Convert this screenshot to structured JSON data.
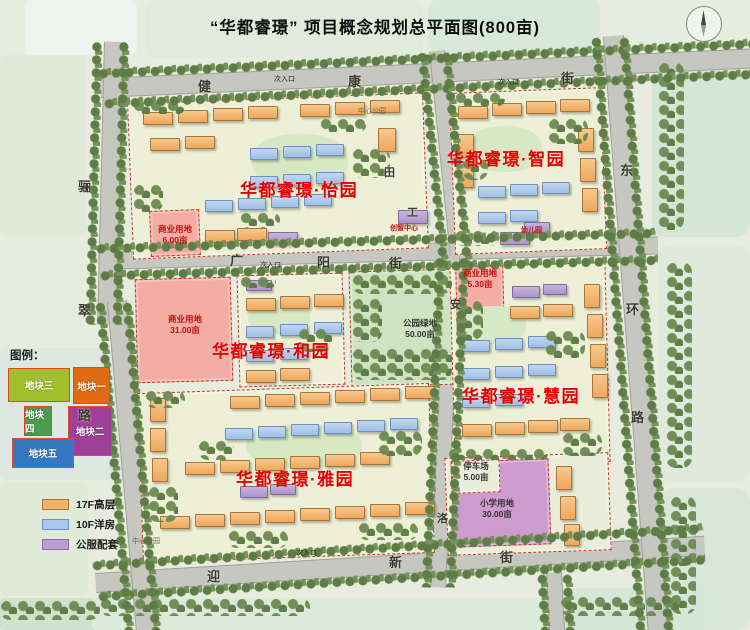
{
  "title": "“华都睿璟” 项目概念规划总平面图(800亩)",
  "colors": {
    "district_label": "#e80000",
    "road": "#c6c7c0",
    "block_boundary": "#c43a28",
    "highrise": "#f0b169",
    "flats": "#a9c7ea",
    "public": "#b5a0cf",
    "commercial": "#f3ada5",
    "school": "#cd9bcd",
    "park": "#cfe3c3"
  },
  "legend": {
    "heading": "图例：",
    "parcels": [
      {
        "label": "地块三",
        "color": "#a2bf2e",
        "x": 8,
        "y": 368,
        "w": 62,
        "h": 34
      },
      {
        "label": "地块一",
        "color": "#e06b12",
        "x": 73,
        "y": 367,
        "w": 37,
        "h": 37
      },
      {
        "label": "地块四",
        "color": "#4d9b50",
        "x": 24,
        "y": 406,
        "w": 28,
        "h": 30
      },
      {
        "label": "地块二",
        "color": "#a03f98",
        "x": 68,
        "y": 406,
        "w": 44,
        "h": 50
      },
      {
        "label": "地块五",
        "color": "#3579c2",
        "x": 12,
        "y": 438,
        "w": 62,
        "h": 30
      }
    ],
    "types": [
      {
        "label": "17F高层",
        "color": "#f0b169",
        "border": "#a97637"
      },
      {
        "label": "10F洋房",
        "color": "#a9c7ea",
        "border": "#7090bd"
      },
      {
        "label": "公服配套",
        "color": "#b5a0cf",
        "border": "#8a6faa"
      }
    ]
  },
  "labels": [
    {
      "cls": "street",
      "name": "street-label-jian",
      "t": "健",
      "x": 198,
      "y": 79
    },
    {
      "cls": "street",
      "name": "street-label-kang",
      "t": "康",
      "x": 348,
      "y": 74
    },
    {
      "cls": "street",
      "name": "street-label-jie-top",
      "t": "街",
      "x": 561,
      "y": 71
    },
    {
      "cls": "street",
      "name": "street-label-guang",
      "t": "广",
      "x": 230,
      "y": 253
    },
    {
      "cls": "street",
      "name": "street-label-yang",
      "t": "阳",
      "x": 317,
      "y": 255
    },
    {
      "cls": "street",
      "name": "street-label-jie-mid",
      "t": "街",
      "x": 389,
      "y": 256
    },
    {
      "cls": "street",
      "name": "street-label-ying",
      "t": "迎",
      "x": 207,
      "y": 569
    },
    {
      "cls": "street",
      "name": "street-label-xin",
      "t": "新",
      "x": 389,
      "y": 555
    },
    {
      "cls": "street",
      "name": "street-label-jie-bottom",
      "t": "街",
      "x": 500,
      "y": 550
    },
    {
      "cls": "street",
      "name": "street-label-li",
      "t": "骊",
      "x": 78,
      "y": 179
    },
    {
      "cls": "street",
      "name": "street-label-cui",
      "t": "翠",
      "x": 78,
      "y": 303
    },
    {
      "cls": "street",
      "name": "street-label-lu-west",
      "t": "路",
      "x": 78,
      "y": 408
    },
    {
      "cls": "street sm",
      "name": "street-label-tian",
      "t": "田",
      "x": 384,
      "y": 166
    },
    {
      "cls": "street sm",
      "name": "street-label-gong",
      "t": "工",
      "x": 407,
      "y": 206
    },
    {
      "cls": "street sm",
      "name": "street-label-an",
      "t": "安",
      "x": 450,
      "y": 298
    },
    {
      "cls": "street sm",
      "name": "street-label-luo",
      "t": "洛",
      "x": 437,
      "y": 512
    },
    {
      "cls": "street",
      "name": "street-label-dong",
      "t": "东",
      "x": 620,
      "y": 163
    },
    {
      "cls": "street",
      "name": "street-label-huan",
      "t": "环",
      "x": 626,
      "y": 302
    },
    {
      "cls": "street",
      "name": "street-label-lu-east",
      "t": "路",
      "x": 631,
      "y": 410
    },
    {
      "cls": "district",
      "name": "district-label-yiyuan",
      "t": "华都睿璟·怡园",
      "x": 240,
      "y": 180
    },
    {
      "cls": "district",
      "name": "district-label-zhiyuan",
      "t": "华都睿璟·智园",
      "x": 447,
      "y": 149
    },
    {
      "cls": "district",
      "name": "district-label-heyuan",
      "t": "华都睿璟·和园",
      "x": 212,
      "y": 341
    },
    {
      "cls": "district",
      "name": "district-label-huiyuan",
      "t": "华都睿璟·慧园",
      "x": 462,
      "y": 386
    },
    {
      "cls": "district",
      "name": "district-label-yayuan",
      "t": "华都睿璟·雅园",
      "x": 236,
      "y": 469
    },
    {
      "cls": "area red",
      "name": "area-label-commercial-1",
      "t": "商业用地\n6.00亩",
      "x": 150,
      "y": 224,
      "w": 50
    },
    {
      "cls": "area red",
      "name": "area-label-commercial-2",
      "t": "商业用地\n31.00亩",
      "x": 158,
      "y": 314,
      "w": 54
    },
    {
      "cls": "area red",
      "name": "area-label-commercial-3",
      "t": "商业用地\n5.30亩",
      "x": 455,
      "y": 268,
      "w": 50
    },
    {
      "cls": "area",
      "name": "area-label-park",
      "t": "公园绿地\n50.00亩",
      "x": 392,
      "y": 318,
      "w": 56
    },
    {
      "cls": "area",
      "name": "area-label-parking",
      "t": "停车场\n5.00亩",
      "x": 453,
      "y": 461,
      "w": 46
    },
    {
      "cls": "area",
      "name": "area-label-school",
      "t": "小学用地\n30.00亩",
      "x": 468,
      "y": 498,
      "w": 58
    },
    {
      "cls": "tiny red",
      "name": "facility-label-center",
      "t": "创智中心",
      "x": 390,
      "y": 224
    },
    {
      "cls": "tiny red",
      "name": "facility-label-kindergarten",
      "t": "幼儿园",
      "x": 521,
      "y": 226
    },
    {
      "cls": "tiny",
      "name": "entrance-label",
      "t": "次入口",
      "x": 274,
      "y": 75
    },
    {
      "cls": "tiny",
      "name": "entrance-label",
      "t": "次入口",
      "x": 498,
      "y": 78
    },
    {
      "cls": "tiny",
      "name": "entrance-label",
      "t": "次入口",
      "x": 260,
      "y": 261
    },
    {
      "cls": "tiny",
      "name": "entrance-label",
      "t": "次入口",
      "x": 296,
      "y": 549
    },
    {
      "cls": "tiny faint",
      "name": "park-label",
      "t": "中心公园",
      "x": 358,
      "y": 107
    },
    {
      "cls": "tiny faint",
      "name": "park-label",
      "t": "中心公园",
      "x": 132,
      "y": 537
    }
  ],
  "map": {
    "patches": [
      [
        25,
        0,
        112,
        55,
        "#eef3ee",
        6
      ],
      [
        145,
        0,
        278,
        58,
        "#e0ebdc",
        10
      ],
      [
        428,
        0,
        172,
        52,
        "#d8e8d9",
        10
      ],
      [
        610,
        0,
        140,
        48,
        "#e4edde",
        8
      ],
      [
        652,
        55,
        98,
        182,
        "#d5e6d6",
        14
      ],
      [
        658,
        245,
        92,
        237,
        "#dfe9dc",
        14
      ],
      [
        660,
        488,
        90,
        142,
        "#d8e7d8",
        14
      ],
      [
        0,
        55,
        86,
        182,
        "#e0ead9",
        8
      ],
      [
        0,
        240,
        80,
        106,
        "#e3ecde",
        8
      ],
      [
        0,
        348,
        128,
        132,
        "#dce8e2",
        6
      ],
      [
        0,
        482,
        88,
        114,
        "#e0ead9",
        8
      ],
      [
        0,
        598,
        148,
        32,
        "#cfe2cf",
        4
      ],
      [
        92,
        598,
        472,
        32,
        "#dcead9",
        4
      ],
      [
        558,
        588,
        148,
        42,
        "#d6e6d7",
        8
      ]
    ],
    "roads": [
      [
        100,
        78,
        660,
        20,
        -2.6
      ],
      [
        98,
        252,
        560,
        18,
        -1.6
      ],
      [
        95,
        573,
        610,
        20,
        -3.5
      ],
      [
        124,
        42,
        283,
        20,
        91.4
      ],
      [
        127,
        300,
        335,
        20,
        85
      ],
      [
        445,
        50,
        220,
        16,
        84.2
      ],
      [
        460,
        256,
        332,
        16,
        92.4
      ],
      [
        624,
        35,
        602,
        21,
        85.7
      ],
      [
        562,
        572,
        58,
        16,
        87
      ]
    ],
    "blocks": [
      [
        130,
        98,
        296,
        156,
        -2.2,
        "res"
      ],
      [
        452,
        90,
        152,
        162,
        -2.2,
        "res"
      ],
      [
        136,
        278,
        96,
        104,
        -1.5,
        "pinkb"
      ],
      [
        238,
        274,
        106,
        112,
        -1.5,
        "res"
      ],
      [
        350,
        270,
        106,
        116,
        -1.5,
        "parkb"
      ],
      [
        452,
        264,
        156,
        200,
        -1.5,
        "res"
      ],
      [
        456,
        266,
        48,
        64,
        -1.5,
        "pinkb"
      ],
      [
        140,
        388,
        292,
        170,
        -2,
        "res"
      ],
      [
        446,
        455,
        164,
        98,
        -2,
        "plainb"
      ],
      [
        150,
        210,
        50,
        46,
        -2.2,
        "pinkb"
      ],
      [
        452,
        460,
        98,
        86,
        -2,
        "schoolb"
      ],
      [
        452,
        460,
        48,
        33,
        -2,
        "plainb"
      ]
    ],
    "courtyards": [
      [
        252,
        134,
        96,
        54
      ],
      [
        468,
        126,
        74,
        46
      ],
      [
        248,
        300,
        62,
        34
      ],
      [
        462,
        306,
        64,
        38
      ],
      [
        246,
        424,
        116,
        44
      ]
    ],
    "buildings": {
      "hi": [
        [
          143,
          112
        ],
        [
          178,
          110
        ],
        [
          213,
          108
        ],
        [
          248,
          106
        ],
        [
          300,
          104
        ],
        [
          335,
          102
        ],
        [
          370,
          100
        ],
        [
          150,
          138
        ],
        [
          185,
          136
        ],
        [
          378,
          128,
          18,
          24
        ],
        [
          205,
          230
        ],
        [
          237,
          228
        ],
        [
          458,
          106
        ],
        [
          492,
          103
        ],
        [
          526,
          101
        ],
        [
          560,
          99
        ],
        [
          578,
          128,
          16,
          24
        ],
        [
          580,
          158,
          16,
          24
        ],
        [
          582,
          188,
          16,
          24
        ],
        [
          458,
          134,
          16,
          24
        ],
        [
          458,
          164,
          16,
          24
        ],
        [
          246,
          298
        ],
        [
          280,
          296
        ],
        [
          314,
          294
        ],
        [
          246,
          370
        ],
        [
          280,
          368
        ],
        [
          584,
          284,
          16,
          24
        ],
        [
          587,
          314,
          16,
          24
        ],
        [
          590,
          344,
          16,
          24
        ],
        [
          592,
          374,
          16,
          24
        ],
        [
          462,
          424
        ],
        [
          495,
          422
        ],
        [
          528,
          420
        ],
        [
          560,
          418
        ],
        [
          510,
          306
        ],
        [
          543,
          304
        ],
        [
          230,
          396
        ],
        [
          265,
          394
        ],
        [
          300,
          392
        ],
        [
          335,
          390
        ],
        [
          370,
          388
        ],
        [
          405,
          386
        ],
        [
          150,
          398,
          16,
          24
        ],
        [
          150,
          428,
          16,
          24
        ],
        [
          152,
          458,
          16,
          24
        ],
        [
          185,
          462
        ],
        [
          220,
          460
        ],
        [
          255,
          458
        ],
        [
          290,
          456
        ],
        [
          325,
          454
        ],
        [
          360,
          452
        ],
        [
          160,
          516
        ],
        [
          195,
          514
        ],
        [
          230,
          512
        ],
        [
          265,
          510
        ],
        [
          300,
          508
        ],
        [
          335,
          506
        ],
        [
          370,
          504
        ],
        [
          405,
          502
        ],
        [
          556,
          466,
          16,
          24
        ],
        [
          560,
          496,
          16,
          24
        ],
        [
          564,
          524,
          16,
          22
        ]
      ],
      "fl": [
        [
          250,
          148
        ],
        [
          283,
          146
        ],
        [
          316,
          144
        ],
        [
          250,
          176
        ],
        [
          283,
          174
        ],
        [
          316,
          172
        ],
        [
          205,
          200
        ],
        [
          238,
          198
        ],
        [
          271,
          196
        ],
        [
          304,
          194
        ],
        [
          478,
          186
        ],
        [
          510,
          184
        ],
        [
          542,
          182
        ],
        [
          478,
          212
        ],
        [
          510,
          210
        ],
        [
          246,
          326
        ],
        [
          280,
          324
        ],
        [
          314,
          322
        ],
        [
          246,
          350
        ],
        [
          280,
          348
        ],
        [
          462,
          340
        ],
        [
          495,
          338
        ],
        [
          528,
          336
        ],
        [
          462,
          368
        ],
        [
          495,
          366
        ],
        [
          528,
          364
        ],
        [
          462,
          396
        ],
        [
          495,
          394
        ],
        [
          225,
          428
        ],
        [
          258,
          426
        ],
        [
          291,
          424
        ],
        [
          324,
          422
        ],
        [
          357,
          420
        ],
        [
          390,
          418
        ]
      ],
      "pub": [
        [
          268,
          232,
          30,
          13
        ],
        [
          398,
          210,
          30,
          14
        ],
        [
          500,
          232,
          30,
          13
        ],
        [
          524,
          222,
          26,
          12
        ],
        [
          246,
          280,
          26,
          11
        ],
        [
          512,
          286,
          28,
          12
        ],
        [
          543,
          284,
          24,
          11
        ],
        [
          240,
          486,
          28,
          12
        ],
        [
          270,
          484,
          26,
          11
        ]
      ]
    },
    "groves": [
      [
        133,
        100,
        52,
        14
      ],
      [
        320,
        118,
        46,
        14
      ],
      [
        133,
        184,
        30,
        28
      ],
      [
        352,
        148,
        38,
        30
      ],
      [
        240,
        212,
        40,
        16
      ],
      [
        455,
        92,
        50,
        14
      ],
      [
        548,
        118,
        40,
        26
      ],
      [
        462,
        158,
        26,
        22
      ],
      [
        455,
        230,
        44,
        16
      ],
      [
        240,
        276,
        36,
        12
      ],
      [
        298,
        328,
        34,
        24
      ],
      [
        352,
        274,
        100,
        20
      ],
      [
        352,
        348,
        100,
        32
      ],
      [
        352,
        298,
        30,
        44
      ],
      [
        455,
        300,
        28,
        40
      ],
      [
        545,
        330,
        40,
        28
      ],
      [
        562,
        432,
        40,
        24
      ],
      [
        145,
        390,
        40,
        18
      ],
      [
        378,
        430,
        44,
        26
      ],
      [
        198,
        440,
        36,
        20
      ],
      [
        148,
        486,
        30,
        36
      ],
      [
        228,
        530,
        60,
        18
      ],
      [
        358,
        522,
        60,
        18
      ],
      [
        448,
        448,
        100,
        12
      ],
      [
        658,
        62,
        26,
        168
      ],
      [
        666,
        262,
        26,
        206
      ],
      [
        670,
        496,
        26,
        118
      ],
      [
        100,
        598,
        210,
        18
      ],
      [
        560,
        596,
        120,
        20
      ],
      [
        0,
        600,
        100,
        20
      ]
    ],
    "tree_rows": [
      [
        98,
        68,
        655,
        -2.6
      ],
      [
        104,
        98,
        650,
        -2.6
      ],
      [
        96,
        243,
        560,
        -1.6
      ],
      [
        100,
        270,
        558,
        -1.6
      ],
      [
        92,
        560,
        612,
        -3.5
      ],
      [
        98,
        591,
        608,
        -3.5
      ],
      [
        103,
        42,
        283,
        91.4
      ],
      [
        130,
        42,
        283,
        91.4
      ],
      [
        106,
        302,
        334,
        85
      ],
      [
        133,
        302,
        333,
        85
      ],
      [
        428,
        52,
        218,
        84.2
      ],
      [
        452,
        52,
        216,
        84.2
      ],
      [
        446,
        258,
        330,
        92.4
      ],
      [
        470,
        258,
        330,
        92.4
      ],
      [
        602,
        37,
        600,
        85.7
      ],
      [
        630,
        37,
        600,
        85.7
      ],
      [
        548,
        574,
        56,
        87
      ],
      [
        573,
        574,
        56,
        87
      ]
    ]
  }
}
